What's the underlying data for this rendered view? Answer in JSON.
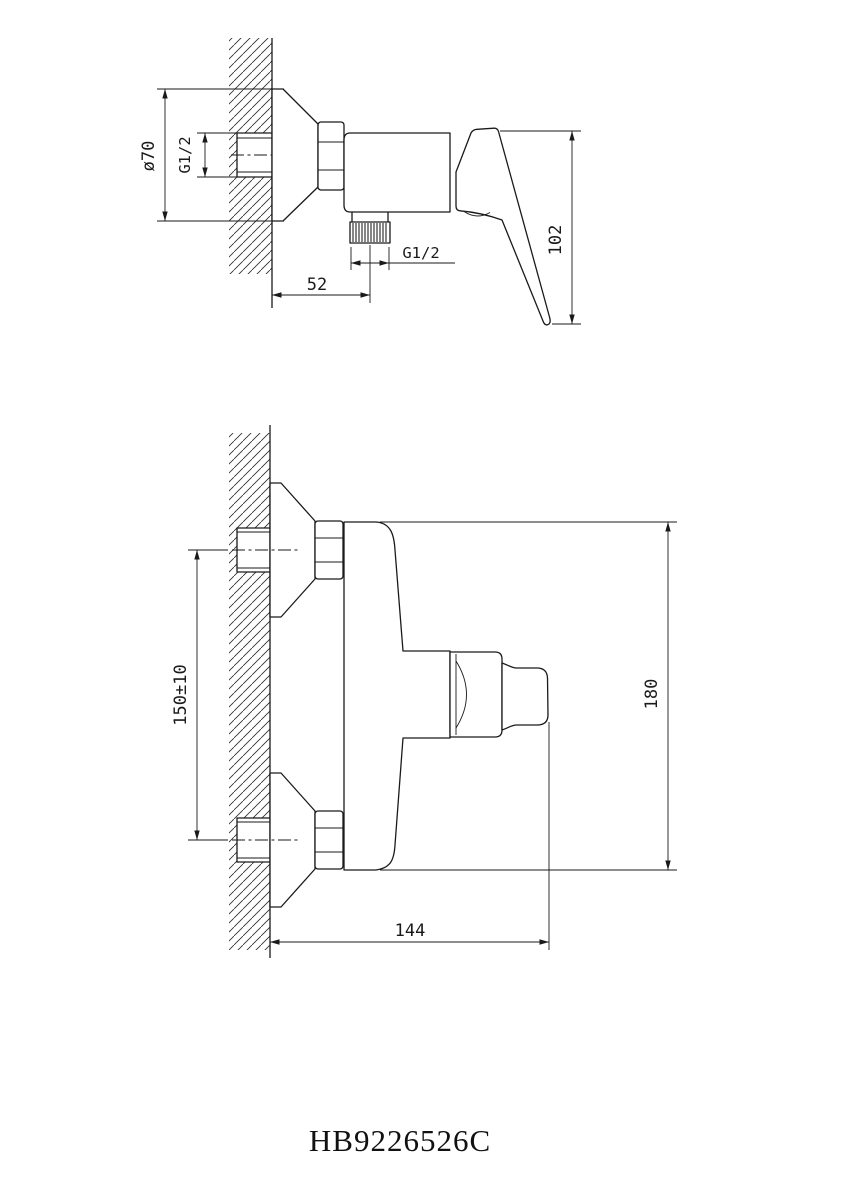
{
  "colors": {
    "line": "#1a1a1a",
    "background": "#ffffff"
  },
  "model_code": "HB9226526C",
  "side_view": {
    "dimensions": {
      "escutcheon_diameter": "ø70",
      "inlet_thread": "G1/2",
      "outlet_thread": "G1/2",
      "outlet_offset": "52",
      "handle_height": "102"
    }
  },
  "plan_view": {
    "dimensions": {
      "inlet_spacing": "150±10",
      "overall_height": "180",
      "overall_depth": "144"
    }
  }
}
